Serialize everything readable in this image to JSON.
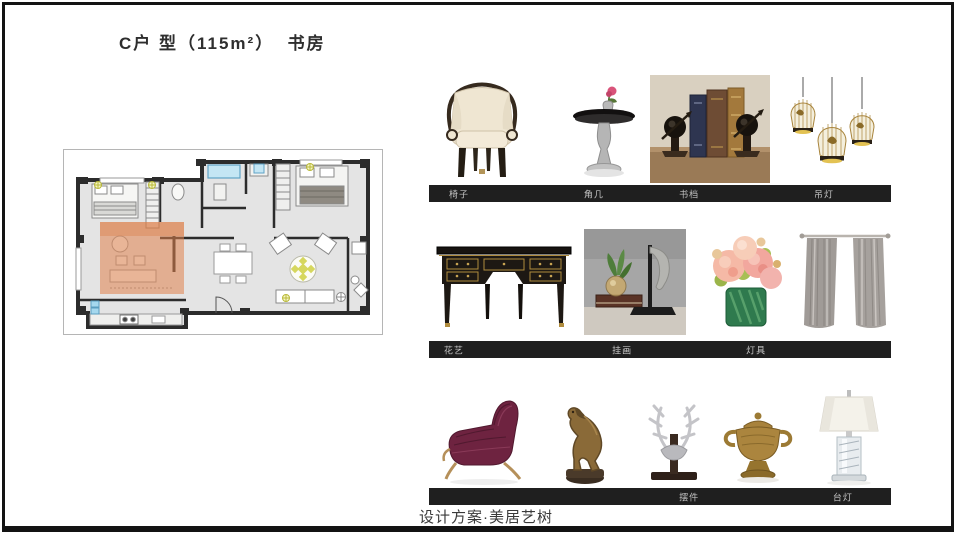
{
  "slide": {
    "title": "C户 型（115m²）  书房",
    "footer": "设计方案·美居艺树"
  },
  "floor_plan": {
    "highlight_room": "书房",
    "highlight_color": "#e0824d",
    "wall_color": "#2c2c2c",
    "room_fill": "#e4e4e4"
  },
  "products": {
    "bar_color": "#1f1f1f",
    "rows": [
      {
        "images": [
          "armchair",
          "side-table",
          "bookends",
          "pendant-lamps"
        ],
        "labels": [
          {
            "text": "椅子"
          },
          {
            "text": "角几"
          },
          {
            "text": "书档"
          },
          {
            "text": "吊灯"
          }
        ]
      },
      {
        "images": [
          "writing-desk",
          "plant-and-sculpture",
          "flower-arrangement",
          "curtains"
        ],
        "labels": [
          {
            "text": "花艺"
          },
          {
            "text": "挂画"
          },
          {
            "text": "灯具"
          }
        ]
      },
      {
        "images": [
          "velvet-lounge-chair",
          "bronze-horse-statue",
          "antler-ornament",
          "brass-urn",
          "crystal-table-lamp"
        ],
        "labels": [
          {
            "text": "摆件"
          },
          {
            "text": "台灯"
          }
        ]
      }
    ]
  }
}
